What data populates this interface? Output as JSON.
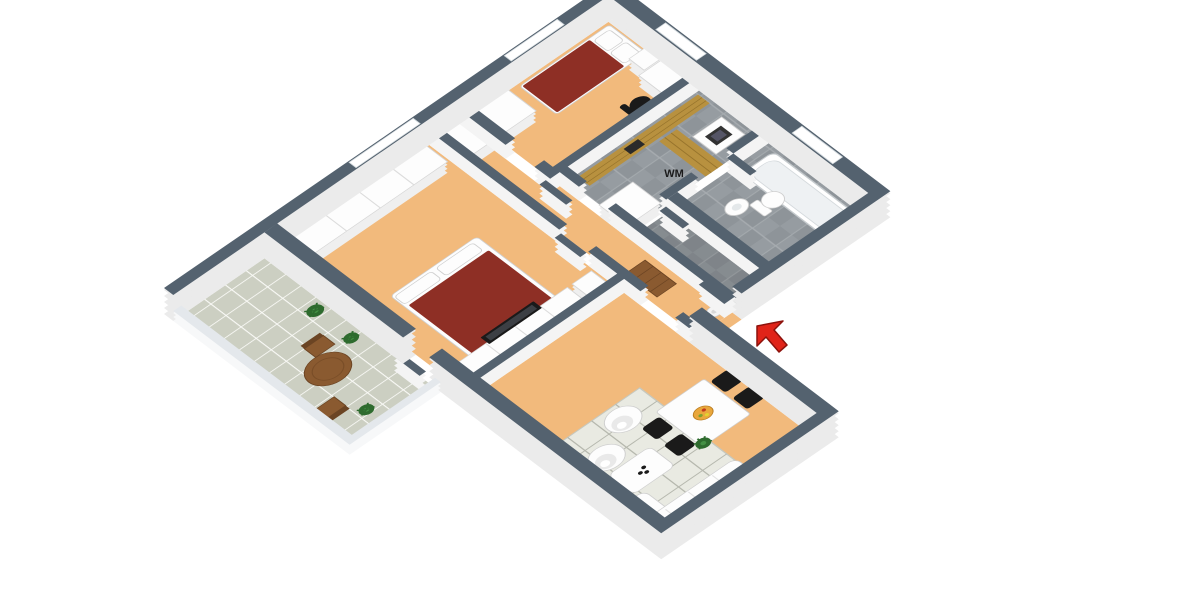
{
  "page": {
    "background": "#ffffff"
  },
  "palette": {
    "pageBg": "#ffffff",
    "wallTop": "#54626f",
    "wallFace": "#f4f4f4",
    "extFace": "#ebebeb",
    "railTop": "#e4e8ec",
    "floorOrange": "#f2ba7c",
    "tileA": "#969ca1",
    "tileB": "#8e9499",
    "tileGrout": "#a7acb0",
    "balconyTile": "#cccfc2",
    "balconyGrout": "#fafaf7",
    "woodCounter": "#b8913f",
    "woodDark": "#97742c",
    "balconyWood": "#8a5a30",
    "bedRed": "#8e2f25",
    "blackFurn": "#1a1a1a",
    "furnWhite": "#fdfdfd",
    "plantGreen": "#2e6b2e",
    "plantLight": "#449044",
    "arrowRed": "#e02419",
    "arrowDark": "#8c120c"
  },
  "labels": {
    "washing_machine": "WM"
  },
  "annotations": {
    "entrance_arrow": {
      "meaning": "entrance pointer",
      "color": "#e02419"
    }
  },
  "scene": {
    "view": "isometric-3d-floor-plan",
    "rooms": [
      {
        "name": "bedroom-top",
        "floor": "orange-parquet",
        "furniture": [
          "single-bed-red",
          "nightstand-with-lamp",
          "desk-with-laptop",
          "office-chair"
        ]
      },
      {
        "name": "bedroom-main",
        "floor": "orange-parquet",
        "furniture": [
          "double-bed-red",
          "wardrobe-row",
          "tv-sideboard",
          "flat-tv"
        ]
      },
      {
        "name": "laundry",
        "floor": "gray-tile",
        "furniture": [
          "wood-counter",
          "wm-counter",
          "washing-machine",
          "counter-sink"
        ]
      },
      {
        "name": "bathroom",
        "floor": "gray-tile",
        "furniture": [
          "bathtub",
          "toilet",
          "pedestal-sink"
        ]
      },
      {
        "name": "wc",
        "floor": "gray-tile",
        "furniture": [
          "door-leaf"
        ]
      },
      {
        "name": "hallway",
        "floor": "orange-parquet",
        "furniture": [
          "wood-bench",
          "floor-lamp"
        ]
      },
      {
        "name": "living-room",
        "floor": "orange-parquet",
        "furniture": [
          "dining-table-white",
          "dining-chairs-black-x4",
          "fruit-bowl",
          "egg-chair-x2",
          "coffee-table",
          "rug-grid",
          "sofa-white-chaise",
          "potted-plant"
        ]
      },
      {
        "name": "balcony",
        "floor": "sage-tile",
        "furniture": [
          "round-wood-table",
          "wood-chair-x2",
          "potted-plant-x3"
        ]
      }
    ],
    "openings": [
      "entrance-door",
      "balcony-door",
      "bedroom-doors",
      "bathroom-door",
      "wc-door",
      "windows-x4"
    ]
  }
}
